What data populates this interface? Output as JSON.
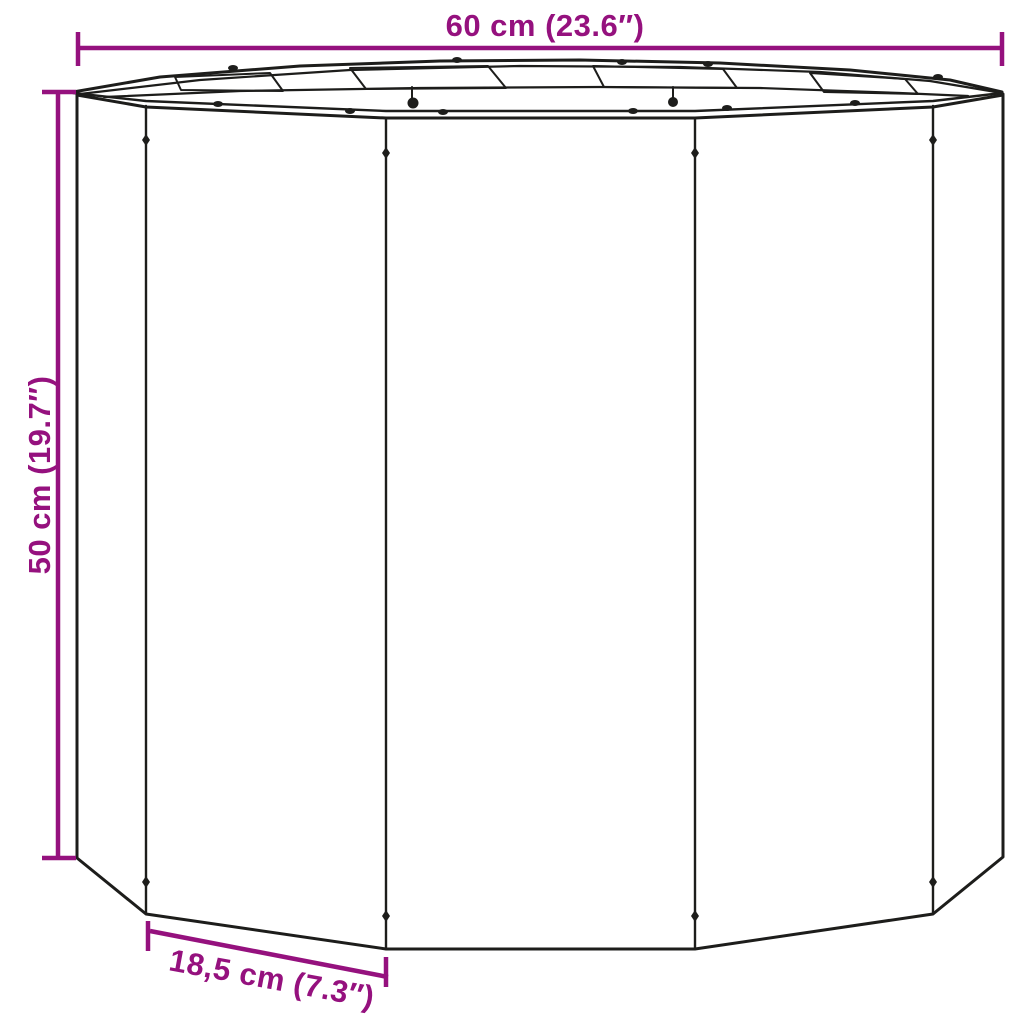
{
  "colors": {
    "background": "#ffffff",
    "line": "#1d1d1b",
    "dimension": "#95117e"
  },
  "diagram": {
    "subject": "twelve-sided-planter-line-drawing",
    "dimensions": {
      "width": {
        "label": "60 cm (23.6″)"
      },
      "height": {
        "label": "50 cm (19.7″)"
      },
      "panel": {
        "label": "18,5 cm (7.3″)"
      }
    }
  }
}
